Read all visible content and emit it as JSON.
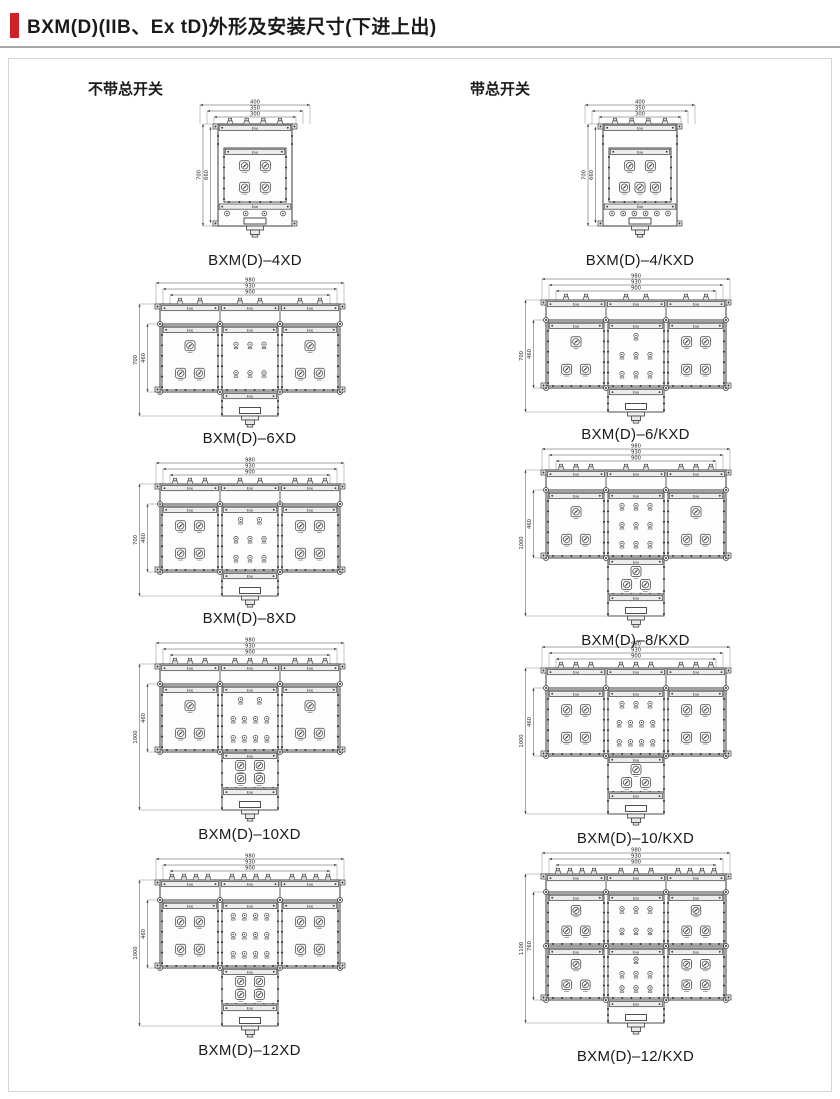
{
  "page": {
    "title": "BXM(D)(IIB、Ex tD)外形及安装尺寸(下进上出)"
  },
  "colors": {
    "accent": "#cf2127",
    "line": "#3b3b3b"
  },
  "labels": {
    "exe": "Exe"
  },
  "columns": [
    {
      "header": "不带总开关",
      "drawings": [
        {
          "model": "BXM(D)–4XD",
          "shape": "tall",
          "dims_top": [
            "400",
            "350",
            "300"
          ],
          "dims_left": [
            "700",
            "660"
          ],
          "top_glands": 4,
          "panel_ops": [
            2,
            2
          ],
          "bottom_glands": 4
        },
        {
          "model": "BXM(D)–6XD",
          "shape": "wide",
          "dims_top": [
            "980",
            "930",
            "900"
          ],
          "dims_left": [
            "700",
            "460"
          ],
          "top_glands": [
            2,
            2,
            2
          ],
          "left_ops": [
            1,
            2
          ],
          "center_ind": [
            3,
            3
          ],
          "right_ops": [
            1,
            2
          ]
        },
        {
          "model": "BXM(D)–8XD",
          "shape": "wide",
          "dims_top": [
            "980",
            "930",
            "900"
          ],
          "dims_left": [
            "700",
            "460"
          ],
          "top_glands": [
            3,
            2,
            3
          ],
          "left_ops": [
            2,
            2
          ],
          "center_ind": [
            2,
            3,
            3
          ],
          "right_ops": [
            2,
            2
          ]
        },
        {
          "model": "BXM(D)–10XD",
          "shape": "tee",
          "dims_top": [
            "980",
            "930",
            "900"
          ],
          "dims_left": [
            "1000",
            "460"
          ],
          "top_glands": [
            3,
            3,
            3
          ],
          "left_ops": [
            1,
            2
          ],
          "center_ind": [
            2,
            4,
            4
          ],
          "right_ops": [
            1,
            2
          ],
          "lower_ops": [
            2,
            2
          ]
        },
        {
          "model": "BXM(D)–12XD",
          "shape": "tee",
          "dims_top": [
            "980",
            "930",
            "900"
          ],
          "dims_left": [
            "1000",
            "460"
          ],
          "top_glands": [
            4,
            4,
            4
          ],
          "left_ops": [
            2,
            2
          ],
          "center_ind": [
            4,
            4,
            4
          ],
          "right_ops": [
            2,
            2
          ],
          "lower_ops": [
            2,
            2
          ]
        }
      ]
    },
    {
      "header": "带总开关",
      "drawings": [
        {
          "model": "BXM(D)–4/KXD",
          "shape": "tall",
          "dims_top": [
            "400",
            "350",
            "300"
          ],
          "dims_left": [
            "700",
            "660"
          ],
          "top_glands": 4,
          "panel_ops": [
            2,
            3
          ],
          "bottom_glands": 6
        },
        {
          "model": "BXM(D)–6/KXD",
          "shape": "wide",
          "dims_top": [
            "980",
            "930",
            "900"
          ],
          "dims_left": [
            "700",
            "460"
          ],
          "top_glands": [
            2,
            2,
            2
          ],
          "left_ops": [
            1,
            2
          ],
          "center_ind": [
            1,
            3,
            3
          ],
          "right_ops": [
            2,
            2
          ]
        },
        {
          "model": "BXM(D)–8/KXD",
          "shape": "tee",
          "dims_top": [
            "980",
            "930",
            "900"
          ],
          "dims_left": [
            "1000",
            "460"
          ],
          "top_glands": [
            3,
            2,
            3
          ],
          "left_ops": [
            1,
            2
          ],
          "center_ind": [
            3,
            3,
            3
          ],
          "right_ops": [
            1,
            2
          ],
          "lower_ops": [
            1,
            2
          ]
        },
        {
          "model": "BXM(D)–10/KXD",
          "shape": "tee",
          "dims_top": [
            "980",
            "930",
            "900"
          ],
          "dims_left": [
            "1000",
            "460"
          ],
          "top_glands": [
            3,
            3,
            3
          ],
          "left_ops": [
            2,
            2
          ],
          "center_ind": [
            3,
            4,
            4
          ],
          "right_ops": [
            2,
            2
          ],
          "lower_ops": [
            1,
            2
          ]
        },
        {
          "model": "BXM(D)–12/KXD",
          "shape": "rows2",
          "dims_top": [
            "980",
            "930",
            "900"
          ],
          "dims_left": [
            "1100",
            "760"
          ],
          "top_glands": [
            4,
            3,
            4
          ],
          "row1": {
            "left_ops": [
              1,
              2
            ],
            "center_ind": [
              3,
              3
            ],
            "right_ops": [
              1,
              2
            ]
          },
          "row2": {
            "left_ops": [
              1,
              2
            ],
            "center_ind": [
              1,
              3,
              3
            ],
            "right_ops": [
              2,
              2
            ]
          }
        }
      ]
    }
  ]
}
